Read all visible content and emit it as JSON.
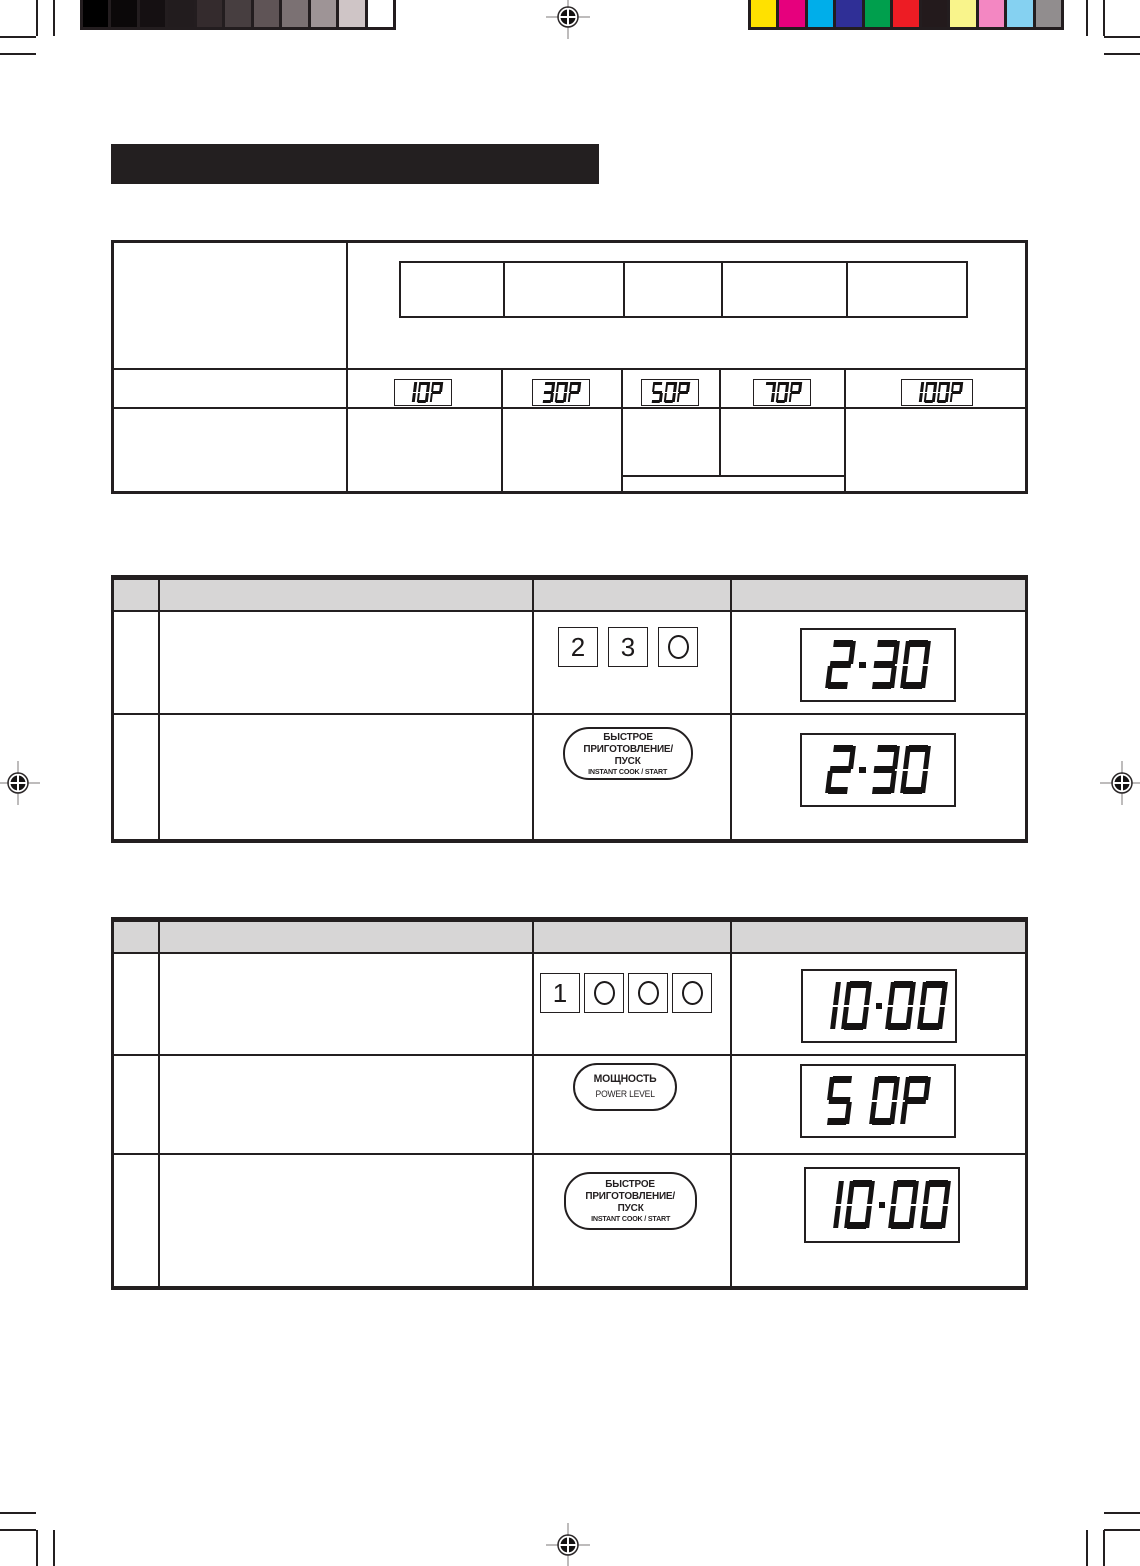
{
  "title_bar_text": "",
  "calibration": {
    "grayscale": [
      "#000000",
      "#0b0809",
      "#151012",
      "#221c1e",
      "#342b2d",
      "#473e40",
      "#5f5456",
      "#7b7173",
      "#9e9496",
      "#cfc5c6",
      "#ffffff"
    ],
    "colors": [
      "#ffe100",
      "#e6007d",
      "#00aeea",
      "#2f2f96",
      "#009f4d",
      "#ed1c24",
      "#231a1c",
      "#f9f48b",
      "#f387c2",
      "#85d1f1",
      "#918d8e"
    ]
  },
  "power_table": {
    "header_cells": [
      "",
      "",
      "",
      "",
      ""
    ],
    "displays": [
      "10P",
      "30P",
      "50P",
      "70P",
      "100P"
    ]
  },
  "step_tables": [
    {
      "steps": [
        {
          "keys": [
            "2",
            "3",
            "0"
          ],
          "display": "2.30"
        },
        {
          "oval_lines": [
            "БЫСТРОЕ",
            "ПРИГОТОВЛЕНИЕ/",
            "ПУСК",
            "INSTANT COOK / START"
          ],
          "display": "2.30"
        }
      ]
    },
    {
      "steps": [
        {
          "keys": [
            "1",
            "0",
            "0",
            "0"
          ],
          "display": "10.00"
        },
        {
          "oval_lines": [
            "МОЩНОСТЬ",
            "POWER LEVEL"
          ],
          "display": "5 0P"
        },
        {
          "oval_lines": [
            "БЫСТРОЕ",
            "ПРИГОТОВЛЕНИЕ/",
            "ПУСК",
            "INSTANT COOK / START"
          ],
          "display": "10.00"
        }
      ]
    }
  ]
}
